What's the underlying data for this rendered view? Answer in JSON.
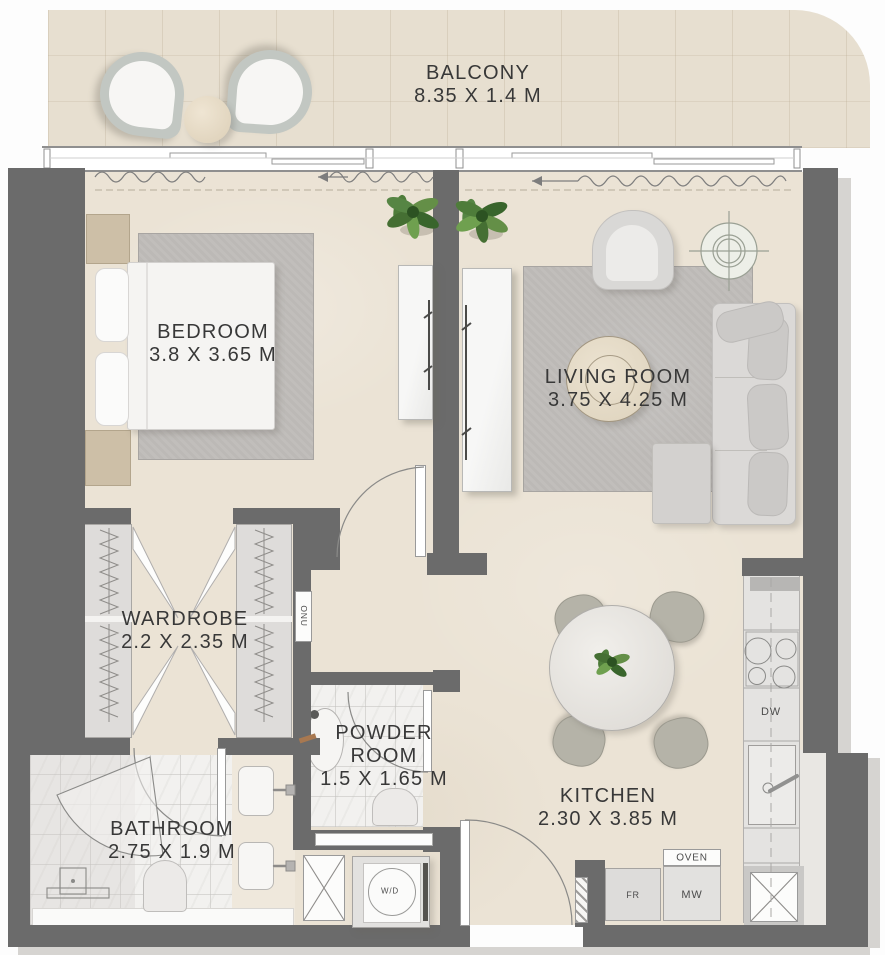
{
  "plan": {
    "rooms": {
      "balcony": {
        "name": "BALCONY",
        "dims": "8.35 X 1.4 M"
      },
      "bedroom": {
        "name": "BEDROOM",
        "dims": "3.8 X 3.65 M"
      },
      "living_room": {
        "name": "LIVING ROOM",
        "dims": "3.75 X 4.25 M"
      },
      "wardrobe": {
        "name": "WARDROBE",
        "dims": "2.2 X 2.35 M"
      },
      "powder_room": {
        "name": "POWDER ROOM",
        "dims": "1.5 X 1.65 M"
      },
      "bathroom": {
        "name": "BATHROOM",
        "dims": "2.75 X 1.9 M"
      },
      "kitchen": {
        "name": "KITCHEN",
        "dims": "2.30 X 3.85 M"
      }
    },
    "appliances": {
      "dishwasher": "DW",
      "oven": "OVEN",
      "fridge": "FR",
      "microwave": "MW",
      "washer_dryer": "W/D",
      "onu": "ONU"
    },
    "colors": {
      "wall": "#6b6b6b",
      "floor": "#ebe3d5",
      "balcony_floor": "#e7dfd0",
      "tile": "#f2f1ef",
      "rug": "#bcb9b6",
      "counter": "#e4e3e1",
      "sofa": "#dbd9d7",
      "wood": "#cdbfa7",
      "text_color": "#383838"
    }
  }
}
